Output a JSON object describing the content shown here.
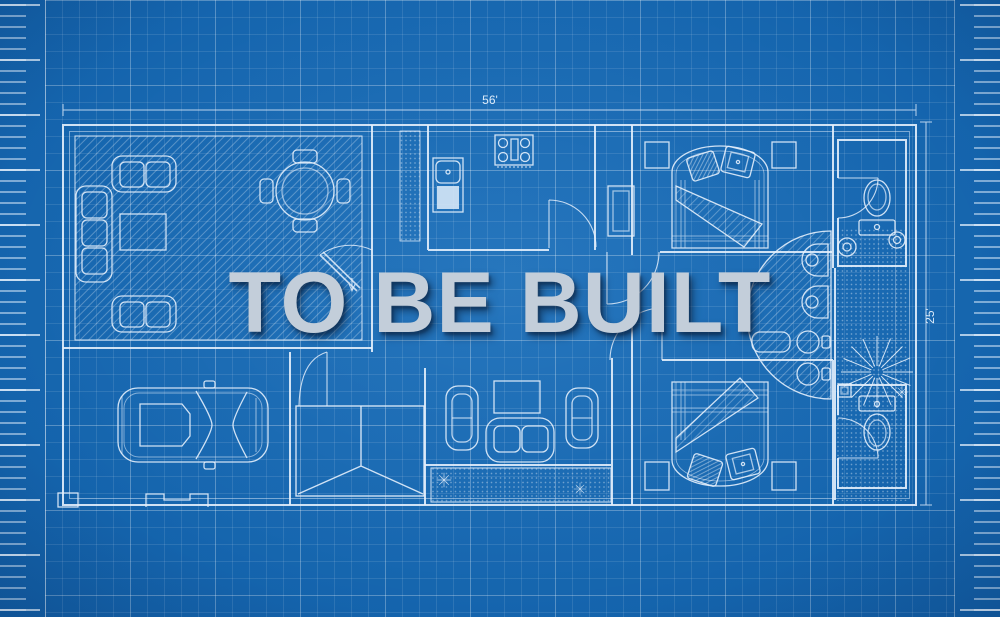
{
  "watermark": {
    "text": "TO BE BUILT",
    "color": "#c3ceda",
    "shadow": "rgba(7,24,48,0.55)"
  },
  "dimensions": {
    "width_label": "56'",
    "height_label": "25'"
  },
  "palette": {
    "paper": "#1565ae",
    "paper_edge": "#0a4a8d",
    "grid_minor": "rgba(255,255,255,0.10)",
    "grid_major": "rgba(255,255,255,0.20)",
    "ink": "#e4effc",
    "fill_light": "#dce9f7"
  },
  "rooms": [
    {
      "name": "living-room",
      "floor": "diagonal-hatch",
      "furniture": [
        "loveseat-icon",
        "sofa-icon",
        "coffee-table-icon",
        "dining-table-icon",
        "chair-icon",
        "loveseat-icon"
      ]
    },
    {
      "name": "kitchen",
      "floor": "plain",
      "furniture": [
        "stove-icon",
        "sink-unit-icon",
        "pantry-icon"
      ]
    },
    {
      "name": "bedroom-top",
      "floor": "plain",
      "furniture": [
        "double-bed-icon",
        "pillow-icon",
        "pillow-icon",
        "nightstand-icon",
        "nightstand-icon"
      ]
    },
    {
      "name": "toilet-room-top",
      "floor": "plain",
      "furniture": [
        "toilet-icon",
        "door-swing-icon"
      ]
    },
    {
      "name": "master-bathroom",
      "floor": "dotted-tile",
      "furniture": [
        "curved-vanity-icon",
        "sink-basin-icon",
        "plant-starburst-icon",
        "sparkle-icon"
      ]
    },
    {
      "name": "bedroom-bottom",
      "floor": "plain",
      "furniture": [
        "double-bed-icon",
        "pillow-icon",
        "pillow-icon",
        "nightstand-icon",
        "nightstand-icon"
      ]
    },
    {
      "name": "toilet-room-bottom",
      "floor": "plain",
      "furniture": [
        "toilet-icon",
        "door-swing-icon"
      ]
    },
    {
      "name": "family-room",
      "floor": "plain",
      "furniture": [
        "tv-console-icon",
        "armchair-icon",
        "armchair-icon",
        "loveseat-icon"
      ]
    },
    {
      "name": "patio",
      "floor": "dotted-tile",
      "furniture": [
        "sparkle-icon",
        "sparkle-icon"
      ]
    },
    {
      "name": "entry-porch",
      "floor": "plain",
      "furniture": [
        "roof-diagonals-icon",
        "double-door-icon"
      ]
    },
    {
      "name": "hallway",
      "floor": "plain",
      "furniture": [
        "closet-icon",
        "door-swing-icon"
      ]
    },
    {
      "name": "garage",
      "floor": "plain",
      "furniture": [
        "car-icon",
        "garage-door-icon"
      ]
    }
  ]
}
